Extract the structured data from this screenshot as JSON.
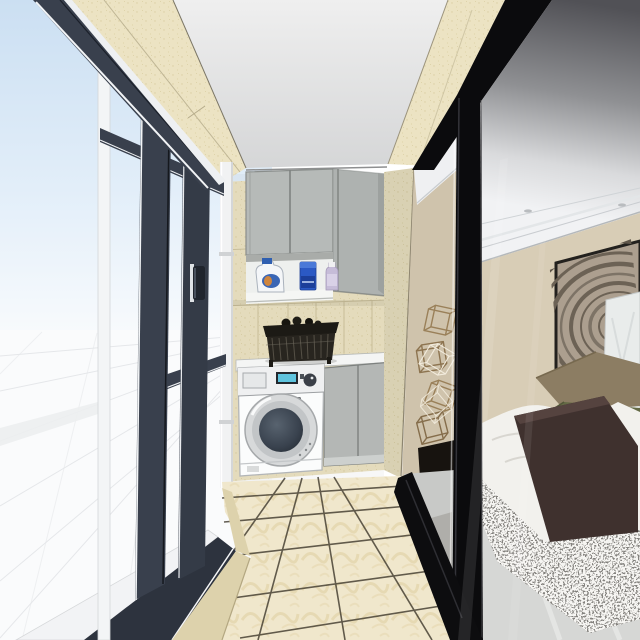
{
  "scene": {
    "title": "3D interior rendering — balcony laundry room with bedroom view",
    "style": "sketchup-render",
    "objects": {
      "left": [
        "sliding-window",
        "sky-view",
        "ground-plane-grid",
        "window-handle"
      ],
      "center": [
        "beige-tile-wall",
        "upper-cabinets",
        "open-shelf",
        "detergent-jug",
        "blue-detergent-bottle",
        "softener-bottle",
        "wire-laundry-basket",
        "countertop",
        "washing-machine",
        "base-cabinet",
        "drain-pipe",
        "beige-floor-tiles"
      ],
      "right": [
        "sliding-glass-door",
        "black-door-frame",
        "wire-cube-sculpture",
        "bedroom-ceiling-molding",
        "recessed-lights",
        "tree-ring-artwork",
        "white-panel",
        "taupe-pillow",
        "olive-pillow",
        "white-duvet-bed",
        "brown-bench",
        "gray-shag-rug",
        "bedroom-floor"
      ]
    },
    "palette": {
      "sky_top": "#cbdff2",
      "sky_bottom": "#f7fafd",
      "ground_white": "#fafbfc",
      "frame_dark": "#39404d",
      "frame_black": "#0b0b0d",
      "trim_white": "#f2f4f6",
      "beam_beige": "#ece3c3",
      "skirt_beige": "#ddd2ac",
      "ceiling_light": "#ebebec",
      "cabinet_gray": "#b6bab8",
      "shelf_white": "#eef0ee",
      "counter_white": "#f4f5f4",
      "washer_white": "#fbfcfc",
      "lcd_blue": "#5fc4de",
      "knob_dark": "#3b4048",
      "door_glass": "#39424e",
      "basket_dark": "#28251f",
      "tile_floor": "#f0e7cc",
      "grout": "#3e382b",
      "glass_gray": "#515156",
      "bedroom_ceiling": "#f1f2f4",
      "bedroom_wall": "#d8cdb6",
      "art_bg": "#ac9f8f",
      "art_ring": "#6c6255",
      "panel_white": "#e9eceb",
      "pillow_taupe": "#8c7d63",
      "pillow_olive": "#646a45",
      "duvet_white": "#f2f1ed",
      "bench_brown": "#3f312e",
      "rug_gray": "#84827e",
      "bedroom_floor": "#d6d7d5",
      "sculpture_gold": "#9a8059",
      "pipe_white": "#f1f2f3"
    }
  }
}
